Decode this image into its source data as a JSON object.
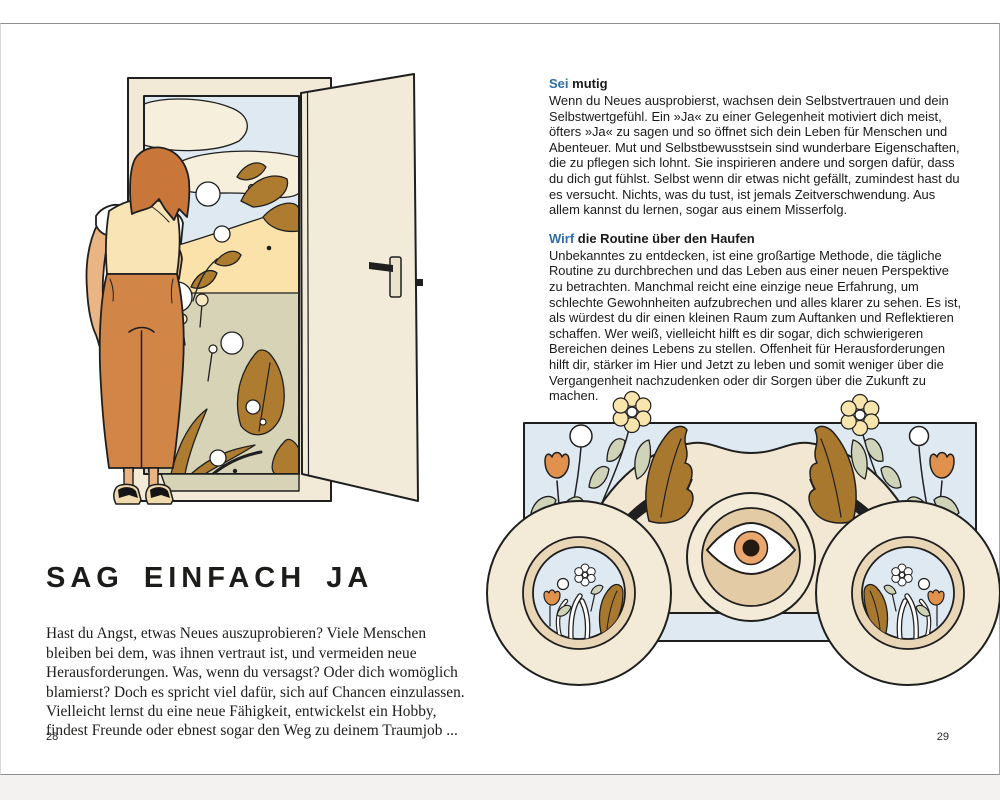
{
  "book": {
    "left_page": {
      "page_number": "28",
      "heading": "SAG EINFACH JA",
      "body": "Hast du Angst, etwas Neues auszuprobieren? Viele Menschen bleiben bei dem, was ihnen vertraut ist, und vermeiden neue Herausforderungen. Was, wenn du versagst? Oder dich womöglich blamierst? Doch es spricht viel dafür, sich auf Chancen einzulassen. Vielleicht lernst du eine neue Fähigkeit, entwickelst ein Hobby, findest Freunde oder ebnest sogar den Weg zu deinem Traumjob ...",
      "illustration": "woman-before-open-door"
    },
    "right_page": {
      "page_number": "29",
      "sections": [
        {
          "lead": "Sei",
          "title_rest": "mutig",
          "body": "Wenn du Neues ausprobierst, wachsen dein Selbstvertrauen und dein Selbstwertgefühl. Ein »Ja« zu einer Gelegenheit motiviert dich meist, öfters »Ja« zu sagen und so öffnet sich dein Leben für Menschen und Abenteuer. Mut und Selbstbewusstsein sind wunderbare Eigenschaften, die zu pflegen sich lohnt. Sie inspirieren andere und sorgen dafür, dass du dich gut fühlst. Selbst wenn dir etwas nicht gefällt, zumindest hast du es versucht. Nichts, was du tust, ist jemals Zeitverschwendung. Aus allem kannst du lernen, sogar aus einem Misserfolg."
        },
        {
          "lead": "Wirf",
          "title_rest": "die Routine über den Haufen",
          "body": "Unbekanntes zu entdecken, ist eine großartige Methode, die tägliche Routine zu durchbrechen und das Leben aus einer neuen Perspektive zu betrachten. Manchmal reicht eine einzige neue Erfahrung, um schlechte Gewohnheiten aufzubrechen und alles klarer zu sehen. Es ist, als würdest du dir einen kleinen Raum zum Auftanken und Reflektieren schaffen. Wer weiß, vielleicht hilft es dir sogar, dich schwierigeren Bereichen deines Lebens zu stellen. Offenheit für Herausforderungen hilft dir, stärker im Hier und Jetzt zu leben und somit weniger über die Vergangenheit nachzudenken oder dir Sorgen über die Zukunft zu machen."
        }
      ],
      "illustration": "binoculars-with-eye-and-flowers"
    }
  },
  "colors": {
    "accent_blue": "#2e6da6",
    "cream": "#f2ead7",
    "sand": "#fbe2ab",
    "sky_blue": "#dfe9f2",
    "olive": "#d6d3b6",
    "golden_brown": "#ad7c30",
    "orange_tulip": "#e0914e",
    "pants_orange": "#d18547",
    "outline": "#1f1f1f"
  }
}
